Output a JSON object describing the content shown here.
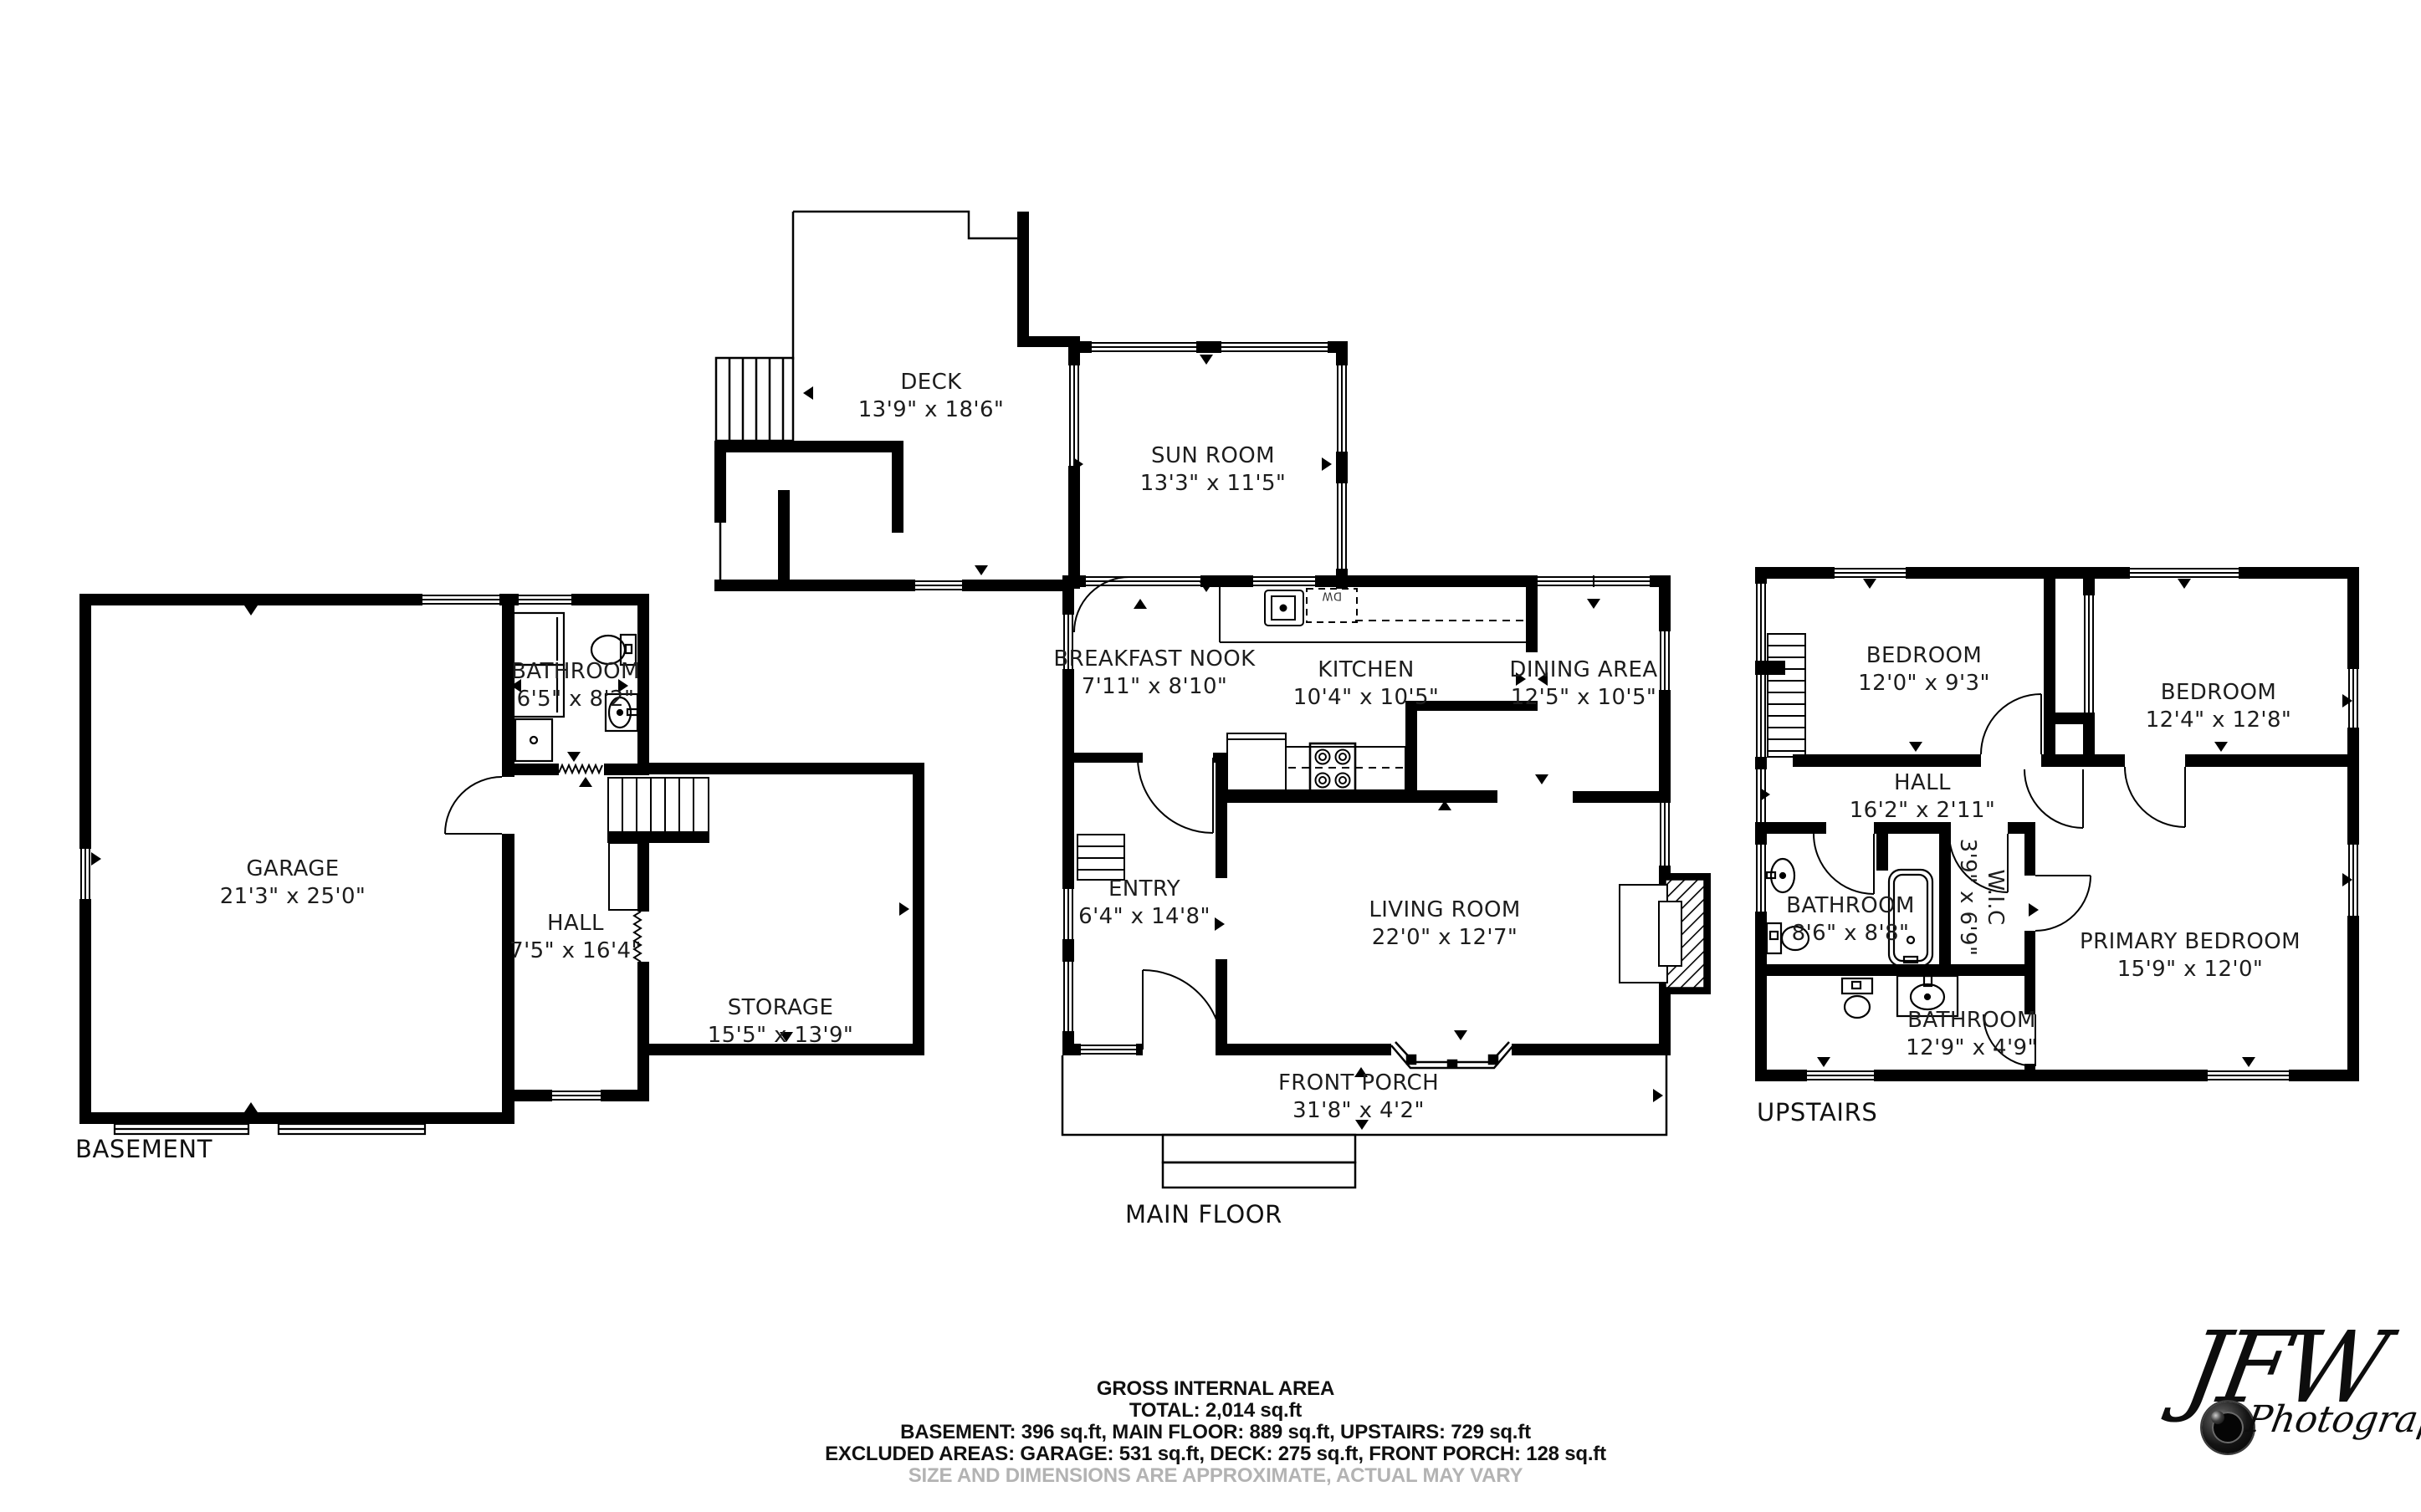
{
  "colors": {
    "wall": "#000000",
    "label_text": "#1d1d1d",
    "muted_text": "#b3b3b3"
  },
  "floors": {
    "basement": {
      "label": "BASEMENT",
      "rooms": [
        {
          "name": "GARAGE",
          "dims": "21'3\" x 25'0\""
        },
        {
          "name": "BATHROOM",
          "dims": "6'5\" x 8'2\""
        },
        {
          "name": "HALL",
          "dims": "7'5\" x 16'4\""
        },
        {
          "name": "STORAGE",
          "dims": "15'5\" x 13'9\""
        }
      ]
    },
    "main": {
      "label": "MAIN FLOOR",
      "dishwasher_label": "DW",
      "rooms": [
        {
          "name": "DECK",
          "dims": "13'9\" x 18'6\""
        },
        {
          "name": "SUN ROOM",
          "dims": "13'3\" x 11'5\""
        },
        {
          "name": "BREAKFAST NOOK",
          "dims": "7'11\" x 8'10\""
        },
        {
          "name": "KITCHEN",
          "dims": "10'4\" x 10'5\""
        },
        {
          "name": "DINING AREA",
          "dims": "12'5\" x 10'5\""
        },
        {
          "name": "ENTRY",
          "dims": "6'4\" x 14'8\""
        },
        {
          "name": "LIVING ROOM",
          "dims": "22'0\" x 12'7\""
        },
        {
          "name": "FRONT PORCH",
          "dims": "31'8\" x 4'2\""
        }
      ]
    },
    "upstairs": {
      "label": "UPSTAIRS",
      "rooms": [
        {
          "name": "BEDROOM",
          "dims": "12'0\" x 9'3\""
        },
        {
          "name": "BEDROOM",
          "dims": "12'4\" x 12'8\""
        },
        {
          "name": "HALL",
          "dims": "16'2\" x 2'11\""
        },
        {
          "name": "BATHROOM",
          "dims": "8'6\" x 8'8\""
        },
        {
          "name": "W.I.C",
          "dims": "3'9\" x 6'9\""
        },
        {
          "name": "PRIMARY BEDROOM",
          "dims": "15'9\" x 12'0\""
        },
        {
          "name": "BATHROOM",
          "dims": "12'9\" x 4'9\""
        }
      ]
    }
  },
  "summary": {
    "heading": "GROSS INTERNAL AREA",
    "total": "TOTAL: 2,014 sq.ft",
    "floors_line": "BASEMENT: 396 sq.ft, MAIN FLOOR: 889 sq.ft, UPSTAIRS: 729 sq.ft",
    "excluded_line": "EXCLUDED AREAS: GARAGE: 531 sq.ft, DECK: 275 sq.ft, FRONT PORCH: 128 sq.ft",
    "disclaimer": "SIZE AND DIMENSIONS ARE APPROXIMATE, ACTUAL MAY VARY"
  },
  "watermark": {
    "initials": "JFW",
    "word": "Photography"
  }
}
